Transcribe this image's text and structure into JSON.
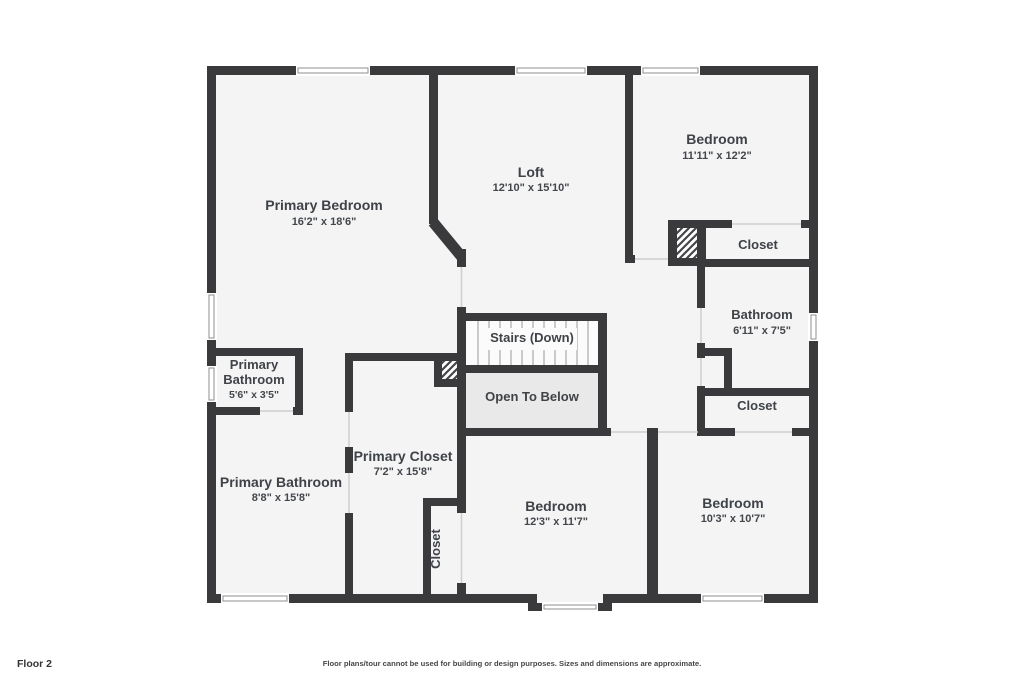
{
  "plan": {
    "floor_label": "Floor 2",
    "disclaimer": "Floor plans/tour cannot be used for building or design purposes. Sizes and dimensions are approximate.",
    "rooms": {
      "primary_bedroom": {
        "name": "Primary Bedroom",
        "dims": "16'2\" x 18'6\""
      },
      "loft": {
        "name": "Loft",
        "dims": "12'10\" x 15'10\""
      },
      "bedroom_top_right": {
        "name": "Bedroom",
        "dims": "11'11\" x 12'2\""
      },
      "closet_top_right": {
        "name": "Closet"
      },
      "bathroom_right": {
        "name": "Bathroom",
        "dims": "6'11\" x 7'5\""
      },
      "closet_right": {
        "name": "Closet"
      },
      "stairs": {
        "name": "Stairs (Down)"
      },
      "open_to_below": {
        "name": "Open To Below"
      },
      "primary_bathroom_small": {
        "name_line1": "Primary",
        "name_line2": "Bathroom",
        "dims": "5'6\" x 3'5\""
      },
      "primary_closet": {
        "name": "Primary Closet",
        "dims": "7'2\" x 15'8\""
      },
      "primary_bathroom": {
        "name": "Primary Bathroom",
        "dims": "8'8\" x 15'8\""
      },
      "closet_vertical": {
        "name": "Closet"
      },
      "bedroom_bottom_center": {
        "name": "Bedroom",
        "dims": "12'3\" x 11'7\""
      },
      "bedroom_bottom_right": {
        "name": "Bedroom",
        "dims": "10'3\" x 10'7\""
      }
    },
    "colors": {
      "wall": "#3a3a3c",
      "room_fill": "#f4f4f5",
      "open_to_below_fill": "#e9e9e9",
      "stairs_fill": "#fbfbfb",
      "text": "#3f4347"
    }
  }
}
